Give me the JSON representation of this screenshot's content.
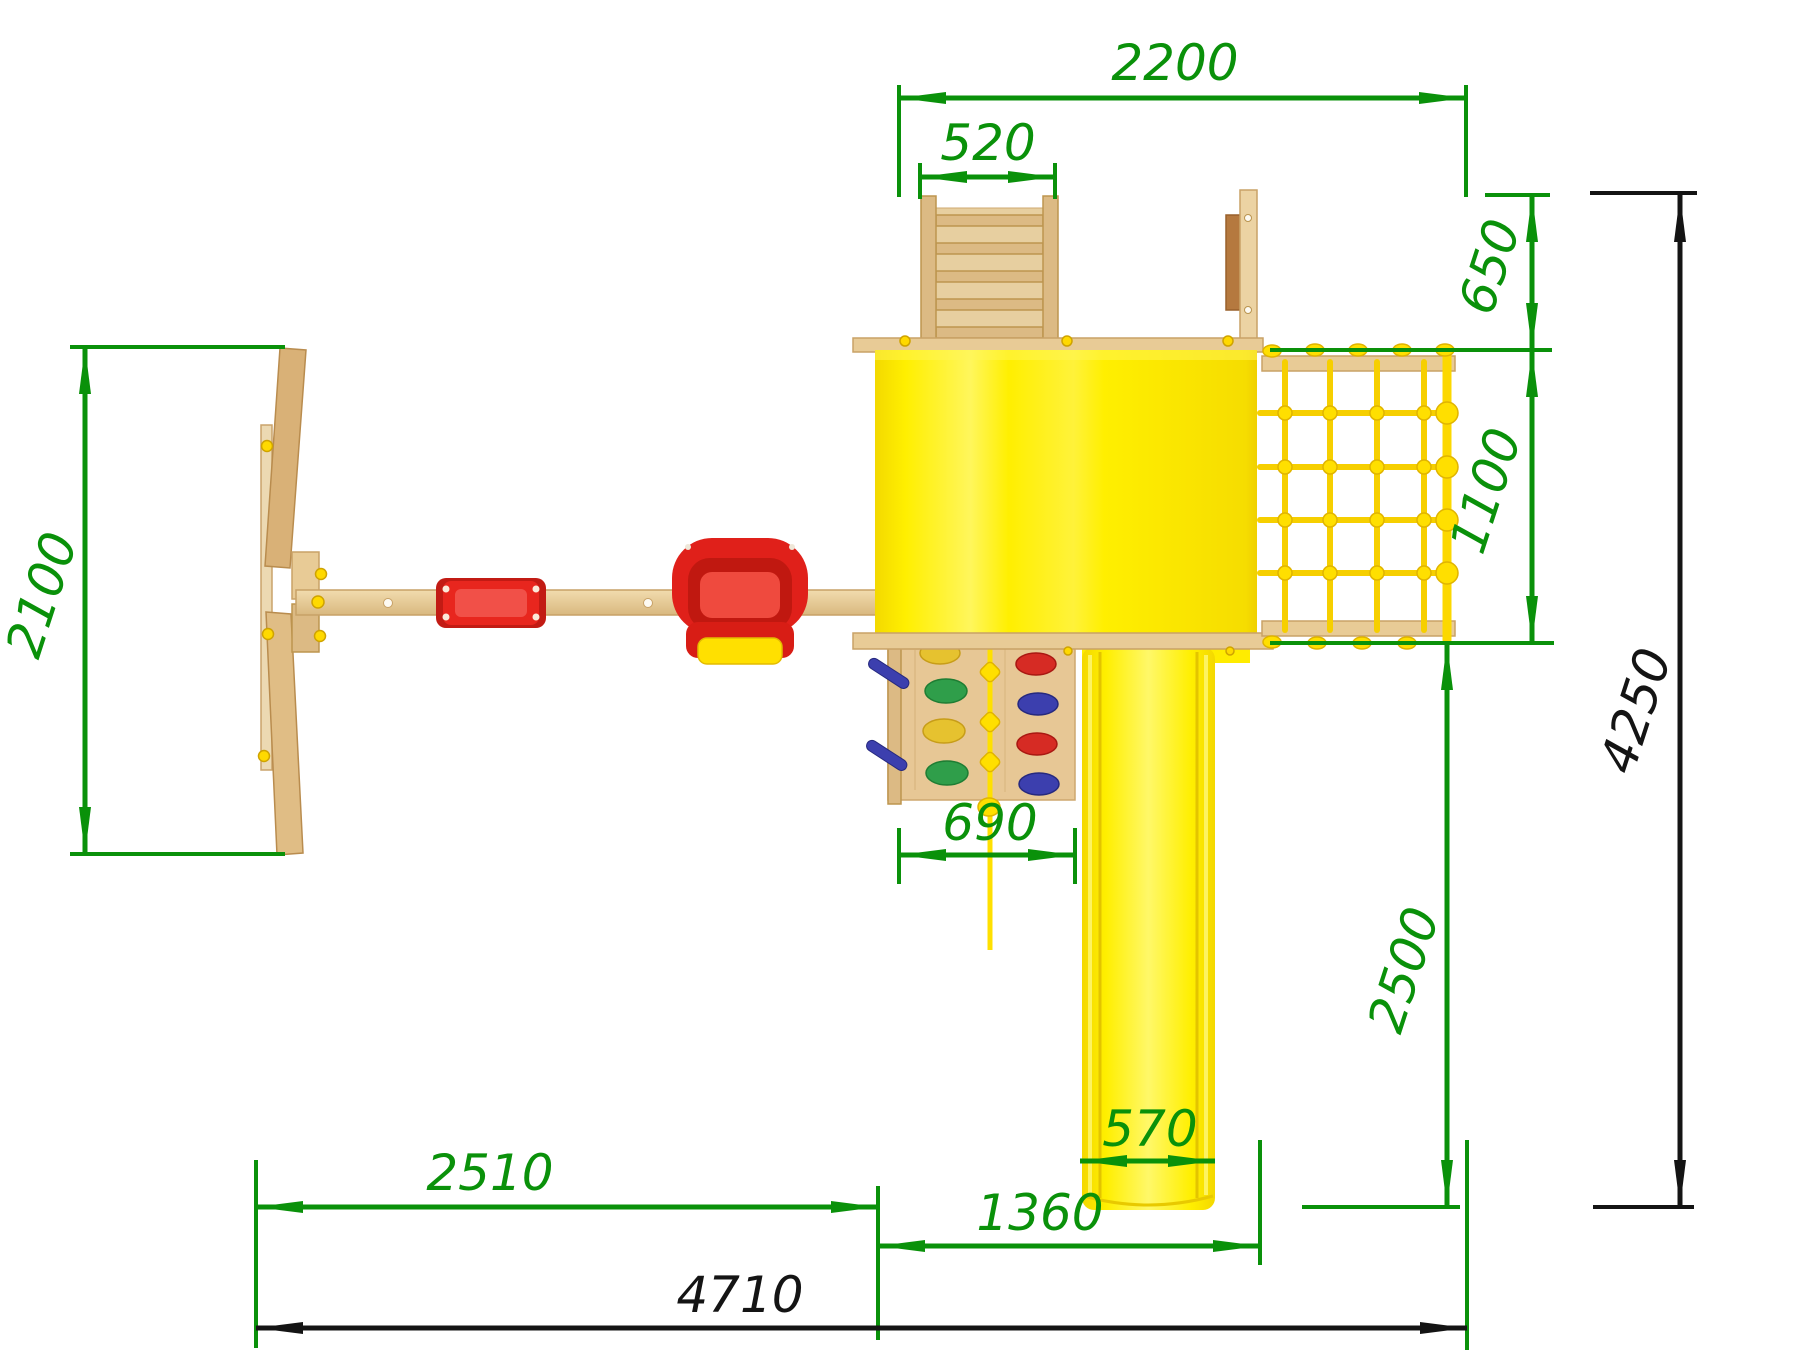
{
  "drawing": {
    "type": "playground-set-top-view-technical-drawing",
    "dimensions": {
      "top_span": "2200",
      "ladder_width": "520",
      "balcony_depth": "650",
      "net_depth": "1100",
      "swing_frame_depth": "2100",
      "climbing_wall_width": "690",
      "slide_run_depth": "2500",
      "overall_depth": "4250",
      "swing_section_width": "2510",
      "slide_width": "570",
      "slide_section_width": "1360",
      "overall_width": "4710"
    },
    "colors": {
      "dimension_green": "#0a910a",
      "dimension_black": "#141414",
      "platform_yellow": "#ffef00",
      "swing_red": "#e8261e",
      "wood_light": "#e8cb96"
    }
  }
}
